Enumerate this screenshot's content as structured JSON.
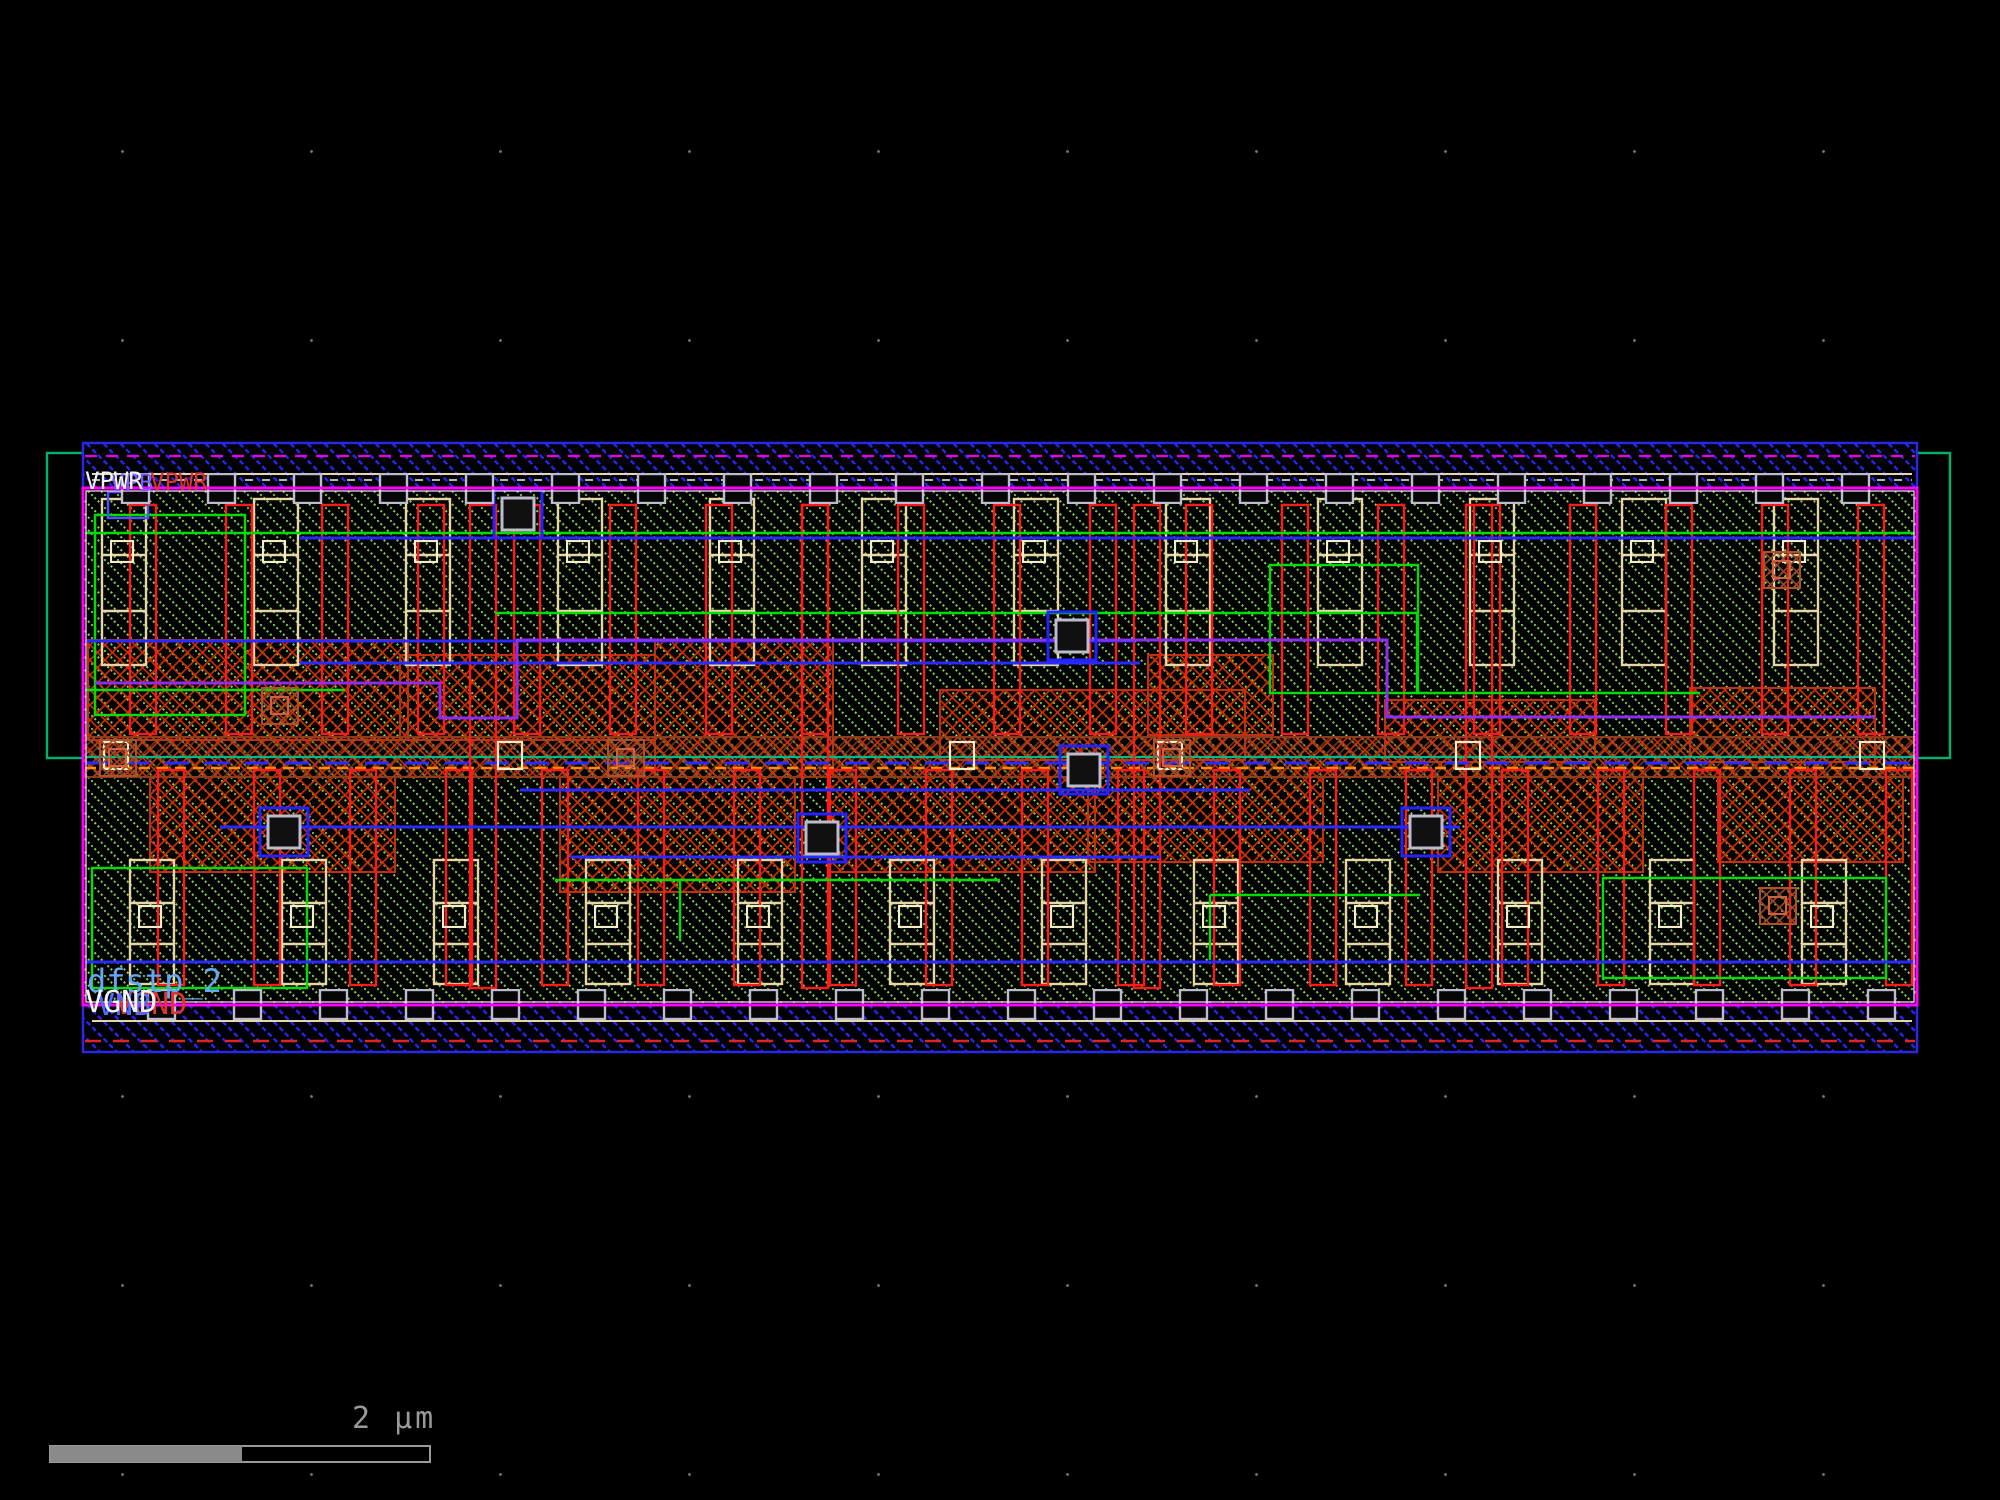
{
  "window": {
    "background": "#000000",
    "description": "IC layout editor canvas showing a standard cell"
  },
  "cell": {
    "name_label": "dfstp_2",
    "power_rail_label": "VPWR",
    "power_rail_overlay_label": "VPB",
    "ground_rail_label": "VGND",
    "ground_rail_overlay_label": "VNB"
  },
  "scale_bar": {
    "label": "2 µm"
  },
  "colors": {
    "background": "#000000",
    "grid_dot": "#6e6e6e",
    "cell_border_magenta": "#ff00ff",
    "metal1_blue": "#2828f0",
    "poly_red": "#ff1a1a",
    "poly_hatch_red": "#d03000",
    "tap_brown": "#9a4a26",
    "local_interconnect_tan": "#e8d5a8",
    "li_hatch_green": "#7fd649",
    "nwell_teal": "#00b36b",
    "diffusion_green": "#00dd00",
    "via_silver": "#bcbccc",
    "metal2_violet": "#8d2df0",
    "orange_marker": "#ff8c00",
    "label_blue": "#63a8f5",
    "scale_gray": "#9a9a9a"
  }
}
